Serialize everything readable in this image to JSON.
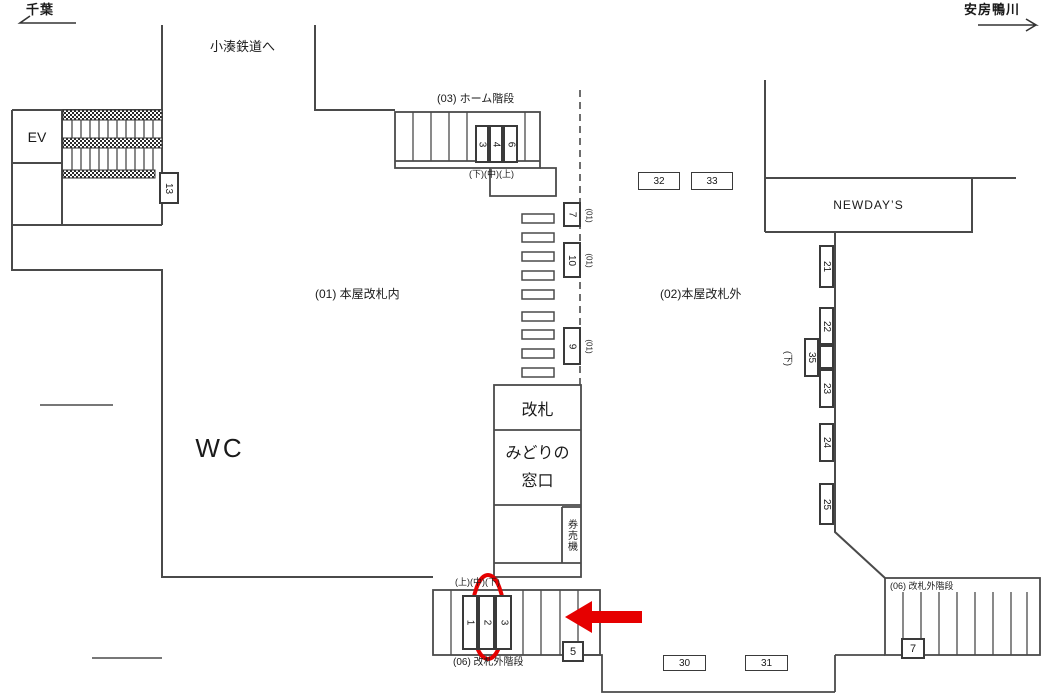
{
  "directions": {
    "left": "千葉",
    "right": "安房鴨川"
  },
  "labels": {
    "kominato": "小湊鉄道へ",
    "zone_inside": "(01) 本屋改札内",
    "zone_outside": "(02)本屋改札外",
    "wc": "WC",
    "ev": "EV",
    "newdays": "NEWDAY’S",
    "kaisatsu": "改札",
    "midori1": "みどりの",
    "midori2": "窓口",
    "kenbaiki": "券売機"
  },
  "platform_stairs": {
    "label": "(03) ホーム階段",
    "sub": "(下)(中)(上)",
    "slots": [
      "3",
      "4",
      "6"
    ]
  },
  "south_stairs": {
    "label": "(06) 改札外階段",
    "sub": "(上)(中)(下)",
    "slots": [
      "1",
      "2",
      "3"
    ]
  },
  "east_stairs": {
    "label": "(06) 改札外階段",
    "box": "7"
  },
  "gates": [
    {
      "num": "7",
      "tag": "(01)"
    },
    {
      "num": "10",
      "tag": "(01)"
    },
    {
      "num": "9",
      "tag": "(01)"
    }
  ],
  "ad_boxes": {
    "b5": "5",
    "b13": "13",
    "b30": "30",
    "b31": "31",
    "b32": "32",
    "b33": "33"
  },
  "wall_strip": {
    "tag": "(下)",
    "b21": "21",
    "b22": "22",
    "b35": "35",
    "b23": "23",
    "b24": "24",
    "b25": "25"
  },
  "colors": {
    "red": "#e60000",
    "line": "#4a4a4a"
  }
}
